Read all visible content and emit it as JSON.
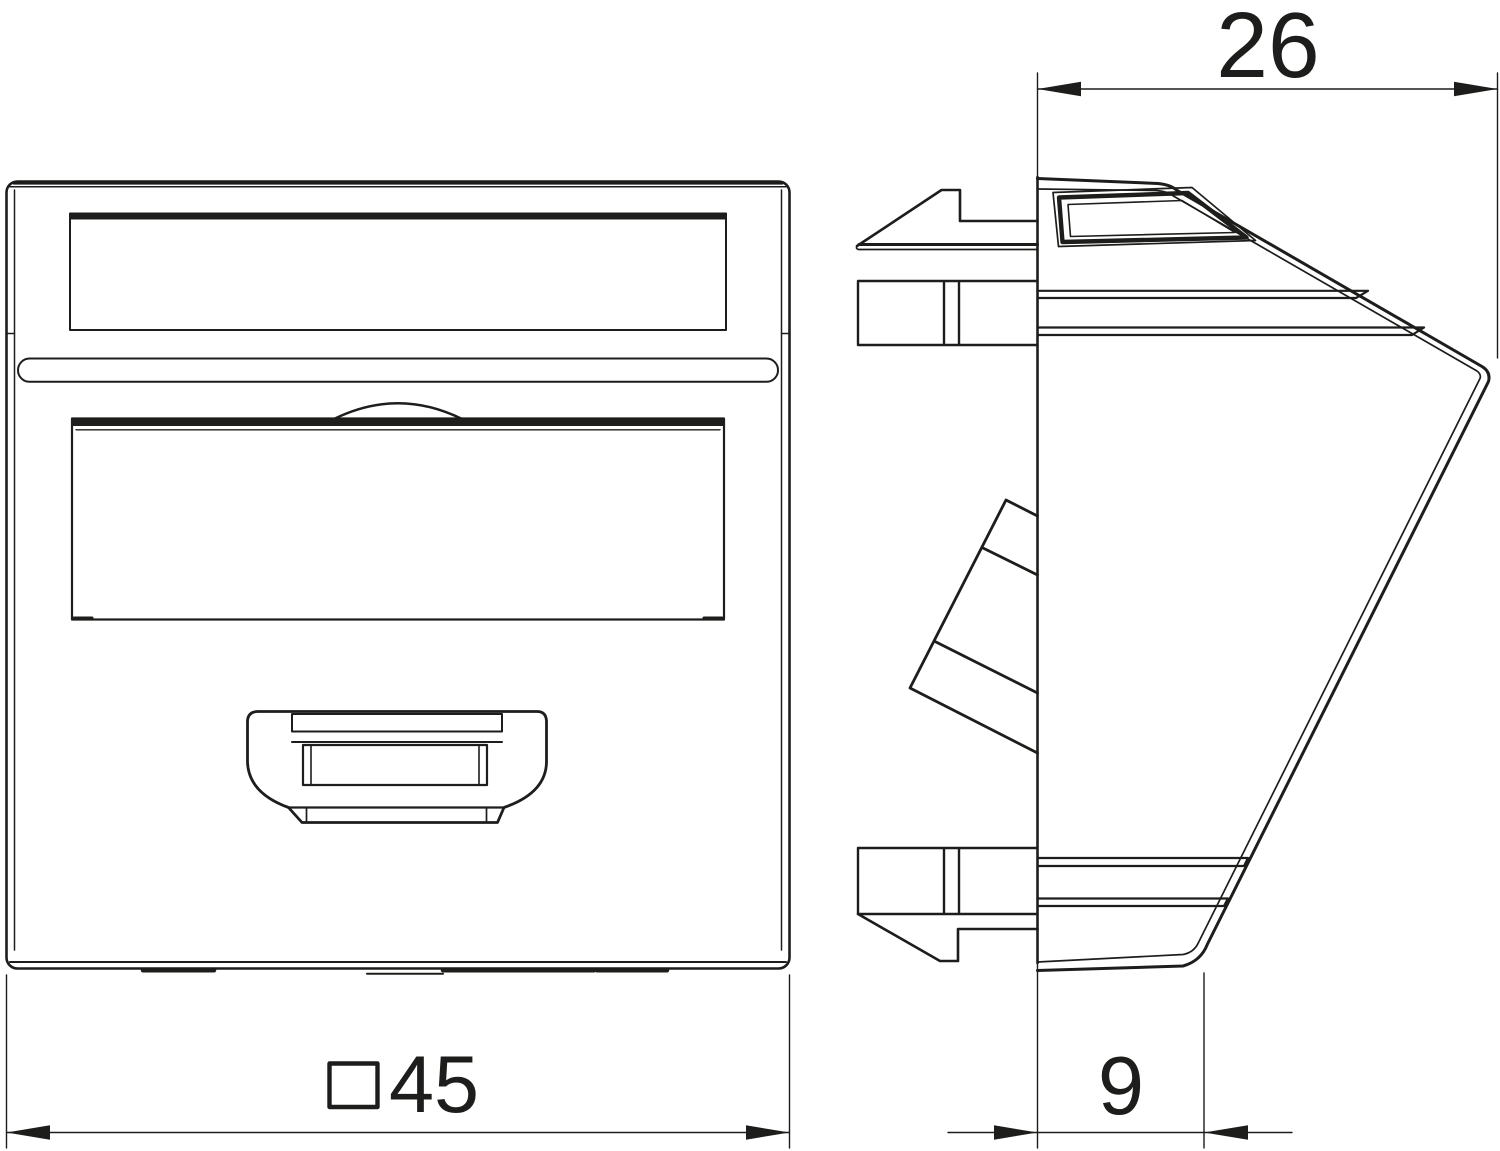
{
  "meta": {
    "drawing_kind": "technical dimension drawing, data socket cover 45x45 with angled outlet, front and side view",
    "background_color": "#ffffff",
    "line_color": "#1d1d1b"
  },
  "views": {
    "front": {
      "label": "front-view"
    },
    "side": {
      "label": "side-view"
    }
  },
  "dimensions": {
    "top_width": {
      "value": "26"
    },
    "bottom_depth": {
      "value": "9"
    },
    "plate": {
      "symbol": "square",
      "value": "45"
    }
  }
}
